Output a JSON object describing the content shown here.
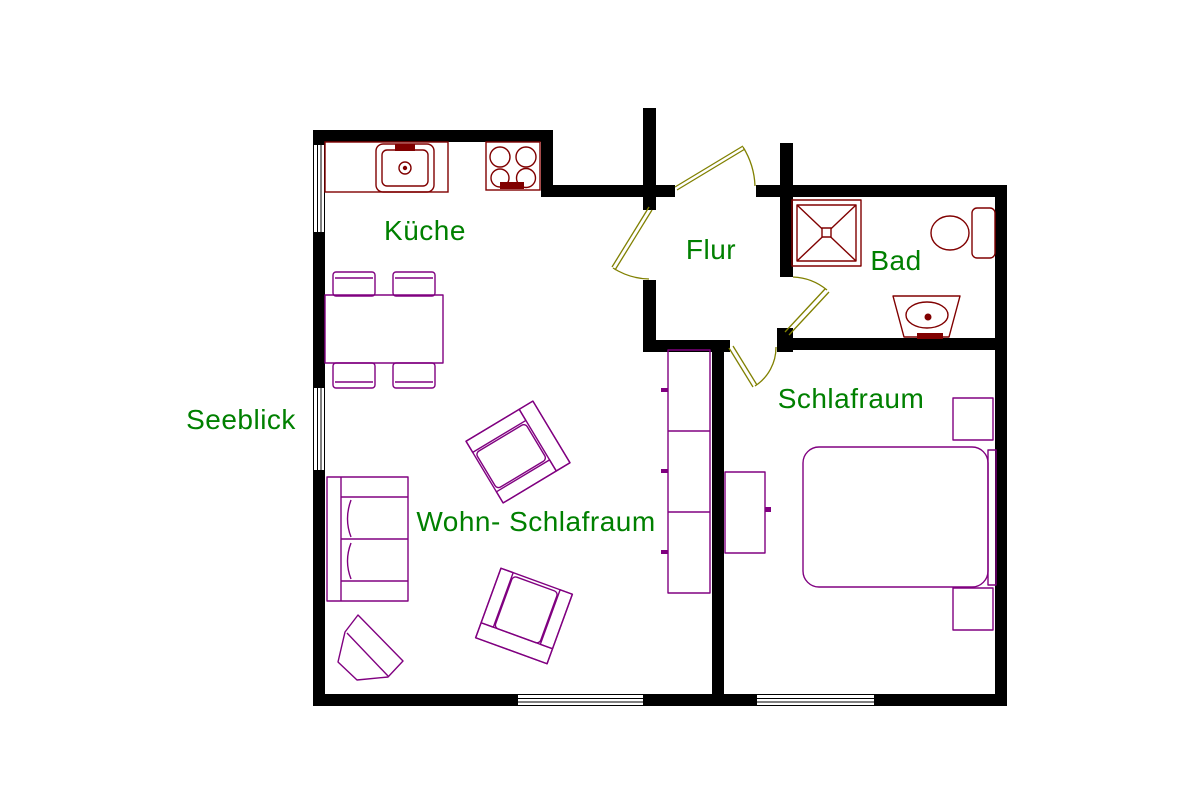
{
  "floorplan": {
    "background_color": "#ffffff",
    "wall_color": "#000000",
    "label_color": "#008000",
    "furniture_color": "#800080",
    "fixture_color": "#800000",
    "door_color": "#808000",
    "labels": {
      "kueche": "Küche",
      "flur": "Flur",
      "bad": "Bad",
      "schlafraum": "Schlafraum",
      "wohn_schlafraum": "Wohn- Schlafraum",
      "seeblick": "Seeblick"
    },
    "icons": [
      "window-icon",
      "door-swing-icon",
      "kitchen-counter-icon",
      "sink-icon",
      "stove-icon",
      "dining-table-icon",
      "chair-icon",
      "sofa-icon",
      "armchair-icon",
      "corner-table-icon",
      "shelf-icon",
      "dresser-icon",
      "bed-icon",
      "nightstand-icon",
      "shower-icon",
      "toilet-icon",
      "washbasin-icon"
    ]
  }
}
